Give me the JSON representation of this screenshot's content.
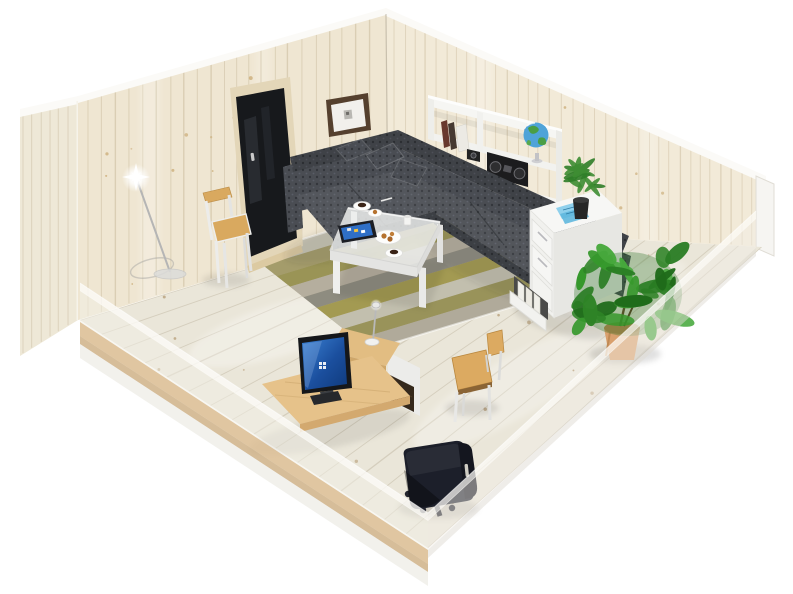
{
  "scene": {
    "description": "Isometric 3D cutaway rendering of a single-room interior with whitewashed pine walls and floor; front walls are semi-transparent",
    "background_color": "#ffffff",
    "room": {
      "wall_material": "whitewashed pine planks",
      "wall_color": "#efe6d2",
      "right_wall_color": "#f2ead8",
      "floor_color": "#eae6d9",
      "trim_color": "#fbfaf7",
      "front_walls": "cutaway, semi-transparent",
      "base_wood_color": "#d8b88a"
    },
    "objects": [
      {
        "id": "door",
        "label": "Dark glazed door with light wood frame",
        "glass_color": "#17191c",
        "frame_color": "#e3d6b8"
      },
      {
        "id": "picture-frame",
        "label": "Framed picture with dark brown frame and white mat",
        "frame_color": "#55402e",
        "mat_color": "#f2f0ec"
      },
      {
        "id": "white-chair",
        "label": "White chair with wooden seat and top rail",
        "wood_color": "#d9a95f",
        "frame_color": "#ececea"
      },
      {
        "id": "floor-lamp",
        "label": "Slim floor lamp, switched on with bright glint",
        "pole_color": "#b5b5b5"
      },
      {
        "id": "corner-sofa",
        "label": "Gray patterned L-shaped corner sofa with cushions",
        "fabric_color": "#4a4d53",
        "pattern_color": "#33363b",
        "pillow_count": 4
      },
      {
        "id": "rug",
        "label": "Striped area rug",
        "stripe_colors": [
          "#c7c4b4",
          "#a49c6b",
          "#9a9456",
          "#b5ae9e",
          "#8e8c80",
          "#a39a52",
          "#c2bfae",
          "#99935a",
          "#b0aa9a"
        ]
      },
      {
        "id": "coffee-table",
        "label": "White coffee table with glass top",
        "color": "#ededeb",
        "items": [
          "tablet",
          "espresso cups with saucers",
          "cookie plate",
          "white mug",
          "dessert plate"
        ]
      },
      {
        "id": "tablet",
        "label": "Tablet with bright blue screen",
        "screen_color": "#2f6fc6"
      },
      {
        "id": "wall-shelf",
        "label": "White two-tier wall shelf",
        "color": "#f6f6f3"
      },
      {
        "id": "binders",
        "label": "Binders and books on shelf",
        "colors": [
          "#69392d",
          "#463931",
          "#eceae4"
        ]
      },
      {
        "id": "camera",
        "label": "Compact black camera",
        "color": "#222222"
      },
      {
        "id": "boombox",
        "label": "Black boombox stereo",
        "color": "#1c1c1e"
      },
      {
        "id": "globe",
        "label": "Desk globe on stand",
        "ocean_color": "#4fa3d8",
        "land_color": "#4a9e45"
      },
      {
        "id": "filing-cabinet",
        "label": "White filing cabinet with open bottom drawer of files",
        "color": "#f5f5f3",
        "papers_color": "#8fd0ec"
      },
      {
        "id": "small-plant",
        "label": "Small spiky potted plant in black pot",
        "pot_color": "#262626",
        "leaf_color": "#3e8d33"
      },
      {
        "id": "large-plant",
        "label": "Large leafy potted plant in terracotta pot",
        "pot_color": "#d9a06d",
        "foliage_palette": [
          "#2e8326",
          "#36982c",
          "#1f6b1a",
          "#46a83c",
          "#2a7d24"
        ]
      },
      {
        "id": "desk",
        "label": "Pine desk with white frame, raised shelf and dark drawer unit",
        "top_color": "#e6c28a",
        "drawer_color": "#35291d"
      },
      {
        "id": "monitor",
        "label": "Monitor with blue desktop screen",
        "screen_color": "#2a6cc0"
      },
      {
        "id": "desk-lamp",
        "label": "Small desk lamp on raised shelf"
      },
      {
        "id": "keyboard",
        "label": "Dark keyboard",
        "color": "#26282c"
      },
      {
        "id": "wooden-chair",
        "label": "Wooden chair with white legs",
        "seat_color": "#dcaa61"
      },
      {
        "id": "office-chair",
        "label": "Black swivel office chair on casters",
        "color": "#1c1f2a"
      },
      {
        "id": "coffee-set",
        "label": "Two coffee cups, cookies and mug on table"
      }
    ]
  }
}
